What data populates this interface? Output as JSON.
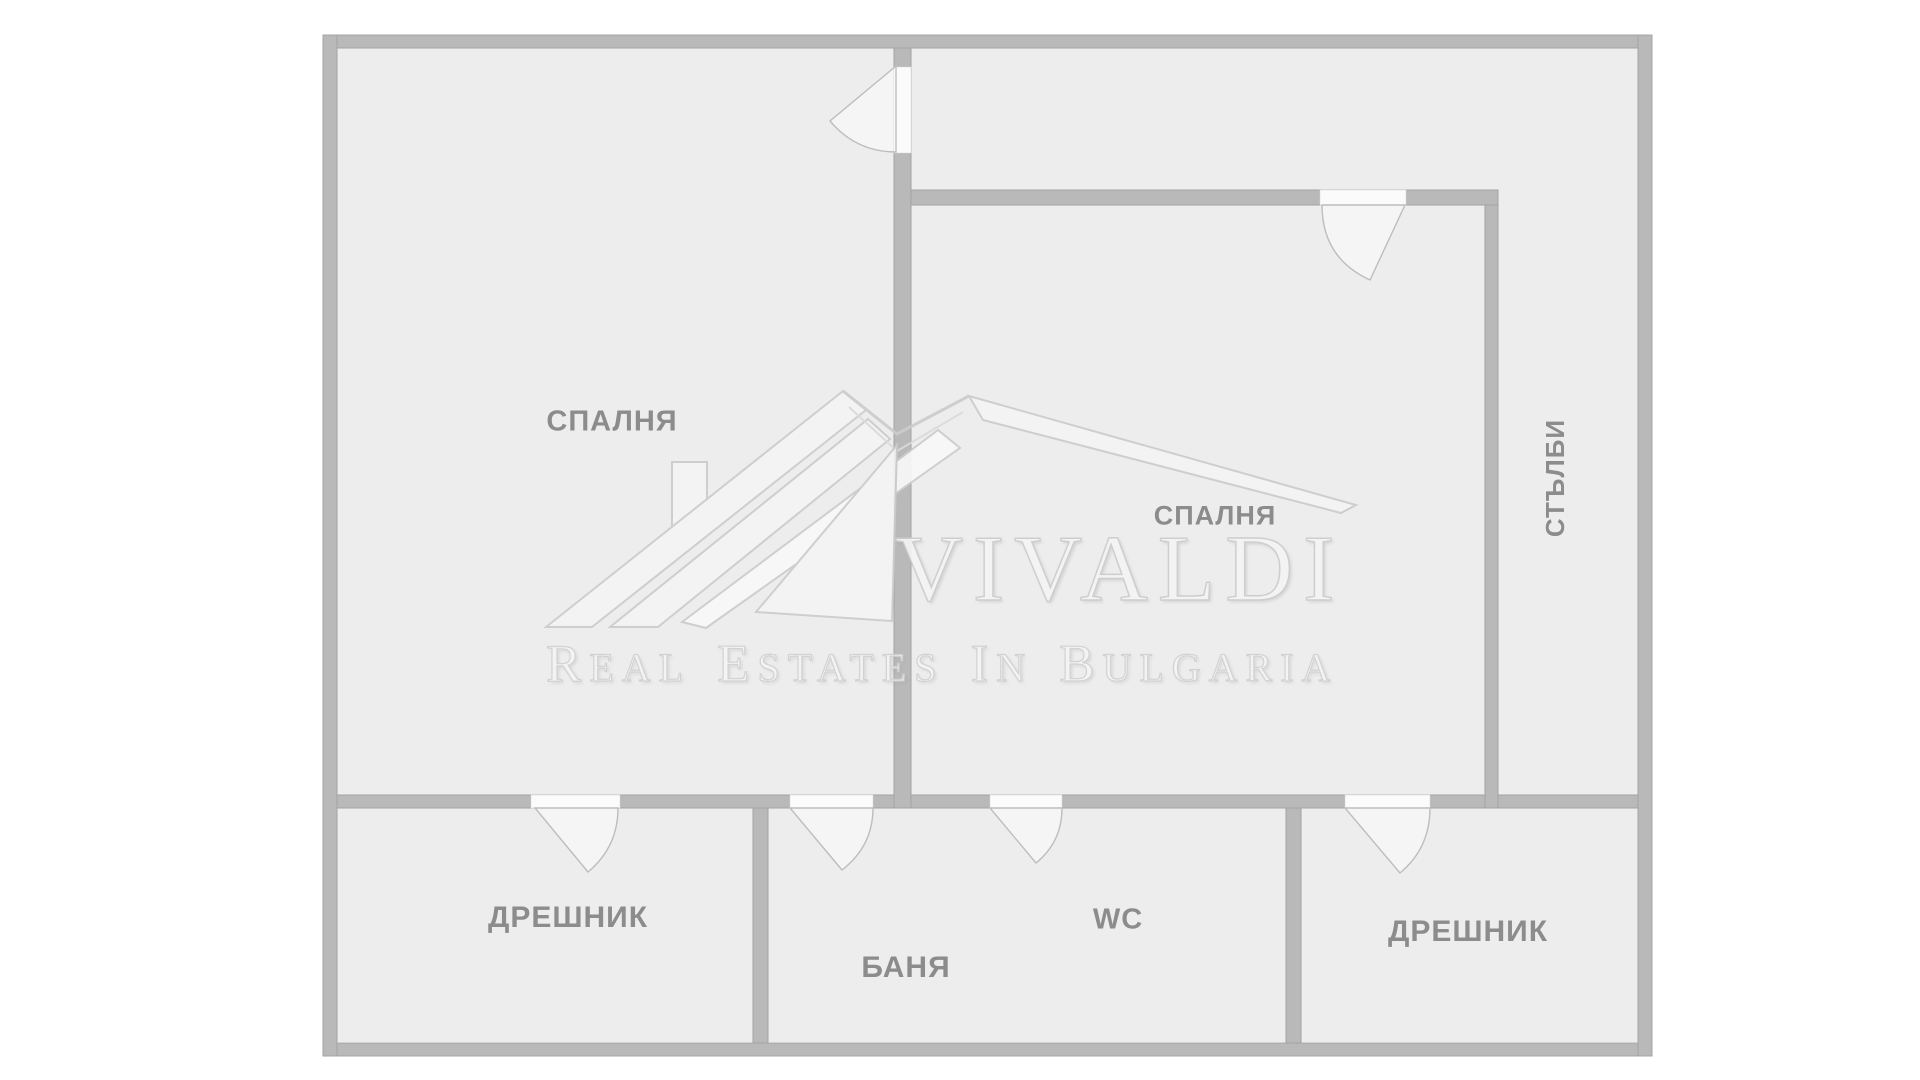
{
  "theme": {
    "background": "#ffffff",
    "floor": "#ededed",
    "wall_fill": "#b9b9b9",
    "wall_edge": "#a4a4a4",
    "door_leaf": "#fbfbfb",
    "label_color": "#8c8c8c",
    "watermark_stroke": "#cccccc",
    "watermark_fill": "#f4f4f4"
  },
  "floor_plan": {
    "rooms": [
      {
        "id": "bedroom-left",
        "label": "СПАЛНЯ"
      },
      {
        "id": "bedroom-right",
        "label": "СПАЛНЯ"
      },
      {
        "id": "stairs",
        "label": "СТЪЛБИ"
      },
      {
        "id": "closet-left",
        "label": "ДРЕШНИК"
      },
      {
        "id": "wc",
        "label": "WC"
      },
      {
        "id": "bath",
        "label": "БАНЯ"
      },
      {
        "id": "closet-right",
        "label": "ДРЕШНИК"
      }
    ]
  },
  "watermark": {
    "brand": "VIVALDI",
    "tagline_words": [
      {
        "initial": "R",
        "rest": "EAL"
      },
      {
        "initial": "E",
        "rest": "STATES"
      },
      {
        "initial": "I",
        "rest": "N"
      },
      {
        "initial": "B",
        "rest": "ULGARIA"
      }
    ]
  }
}
